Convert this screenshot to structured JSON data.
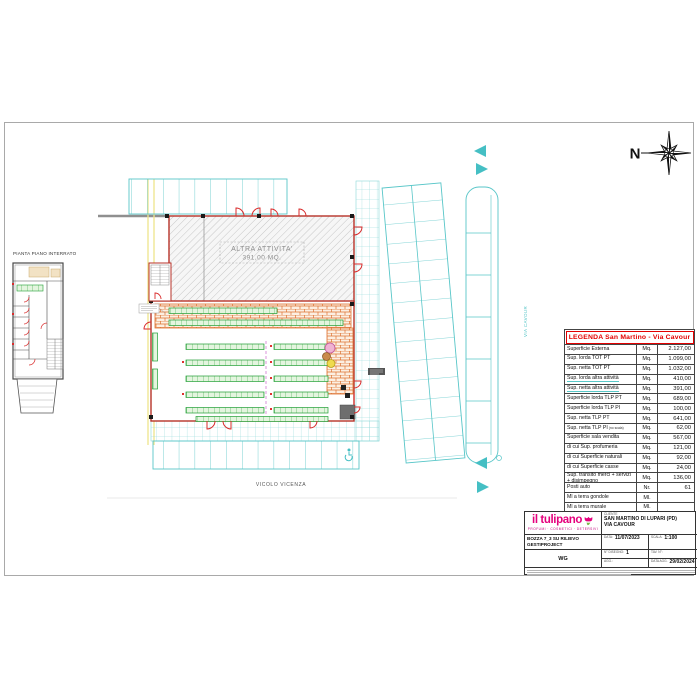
{
  "compass": {
    "north_label": "N"
  },
  "plan": {
    "basement_title": "PIANTA PIANO INTERRATO",
    "altra_attivita_1": "ALTRA ATTIVITA'",
    "altra_attivita_2": "391,00 MQ.",
    "street_bottom": "VICOLO VICENZA",
    "street_right": "VIA CAVOUR"
  },
  "legend": {
    "title": "LEGENDA San Martino - Via Cavour",
    "rows": [
      {
        "label": "Superficie Esterna",
        "unit": "Mq.",
        "value": "2.127,00"
      },
      {
        "label": "Sup. lorda TOT PT",
        "unit": "Mq.",
        "value": "1.099,00"
      },
      {
        "label": "Sup. netta TOT PT",
        "unit": "Mq.",
        "value": "1.032,00"
      },
      {
        "label": "Sup. lorda altra attività",
        "unit": "Mq.",
        "value": "410,00"
      },
      {
        "label": "Sup. netta altra attività",
        "unit": "Mq.",
        "value": "391,00"
      },
      {
        "label": "Superficie lorda TLP PT",
        "unit": "Mq.",
        "value": "689,00"
      },
      {
        "label": "Superficie lorda  TLP PI",
        "unit": "Mq.",
        "value": "100,00"
      },
      {
        "label": "Sup. netta  TLP PT",
        "unit": "Mq.",
        "value": "641,00"
      },
      {
        "label": "Sup. netta TLP PI",
        "note": "(no scala)",
        "unit": "Mq.",
        "value": "62,00"
      },
      {
        "label": "Superficie sala vendita",
        "unit": "Mq.",
        "value": "567,00"
      },
      {
        "label": "di cui Sup.  profumeria",
        "unit": "Mq.",
        "value": "121,00"
      },
      {
        "label": "di cui Superficie  naturali",
        "unit": "Mq.",
        "value": "92,00"
      },
      {
        "label": "di cui Superficie casse",
        "unit": "Mq.",
        "value": "24,00"
      },
      {
        "label": "Sup. transito merci + servizi + disimpegno",
        "unit": "Mq.",
        "value": "136,00"
      },
      {
        "label": "Posti auto",
        "unit": "Nr.",
        "value": "61"
      },
      {
        "label": "Ml a terra gondole",
        "unit": "Ml.",
        "value": ""
      },
      {
        "label": "Ml a terra murale",
        "unit": "Ml.",
        "value": ""
      }
    ]
  },
  "titleblock": {
    "logo_name": "il tulipano",
    "logo_tagline": "PROFUMI · COSMETICI · DETERSIVI",
    "cliente_label": "CLIENTE",
    "cliente_line1": "SAN MARTINO DI LUPARI (PD)",
    "cliente_line2": "VIA CAVOUR",
    "project_line1": "BOZZA 7_3 SU RILIEVO",
    "project_line2": "GESTIPROJECT",
    "initials": "WG",
    "data_label": "DATA:",
    "data_value": "11/07/2023",
    "scala_label": "SCALA:",
    "scala_value": "1:100",
    "disegno_label": "N° DISEGNO:",
    "disegno_value": "1",
    "tav_label": "TAV. N°:",
    "tav_value": "",
    "agg_label": "AGG.:",
    "agg_value": "",
    "dataagg_label": "DATA AGG.",
    "dataagg_value": "29/02/2024"
  },
  "colors": {
    "teal": "#58C6C8",
    "wall_red": "#B73228",
    "door_red": "#D92B2B",
    "shelf_green": "#1E9E33",
    "brick_orange": "#DE7130",
    "logo_magenta": "#E5007D",
    "legend_red": "#E30000"
  }
}
